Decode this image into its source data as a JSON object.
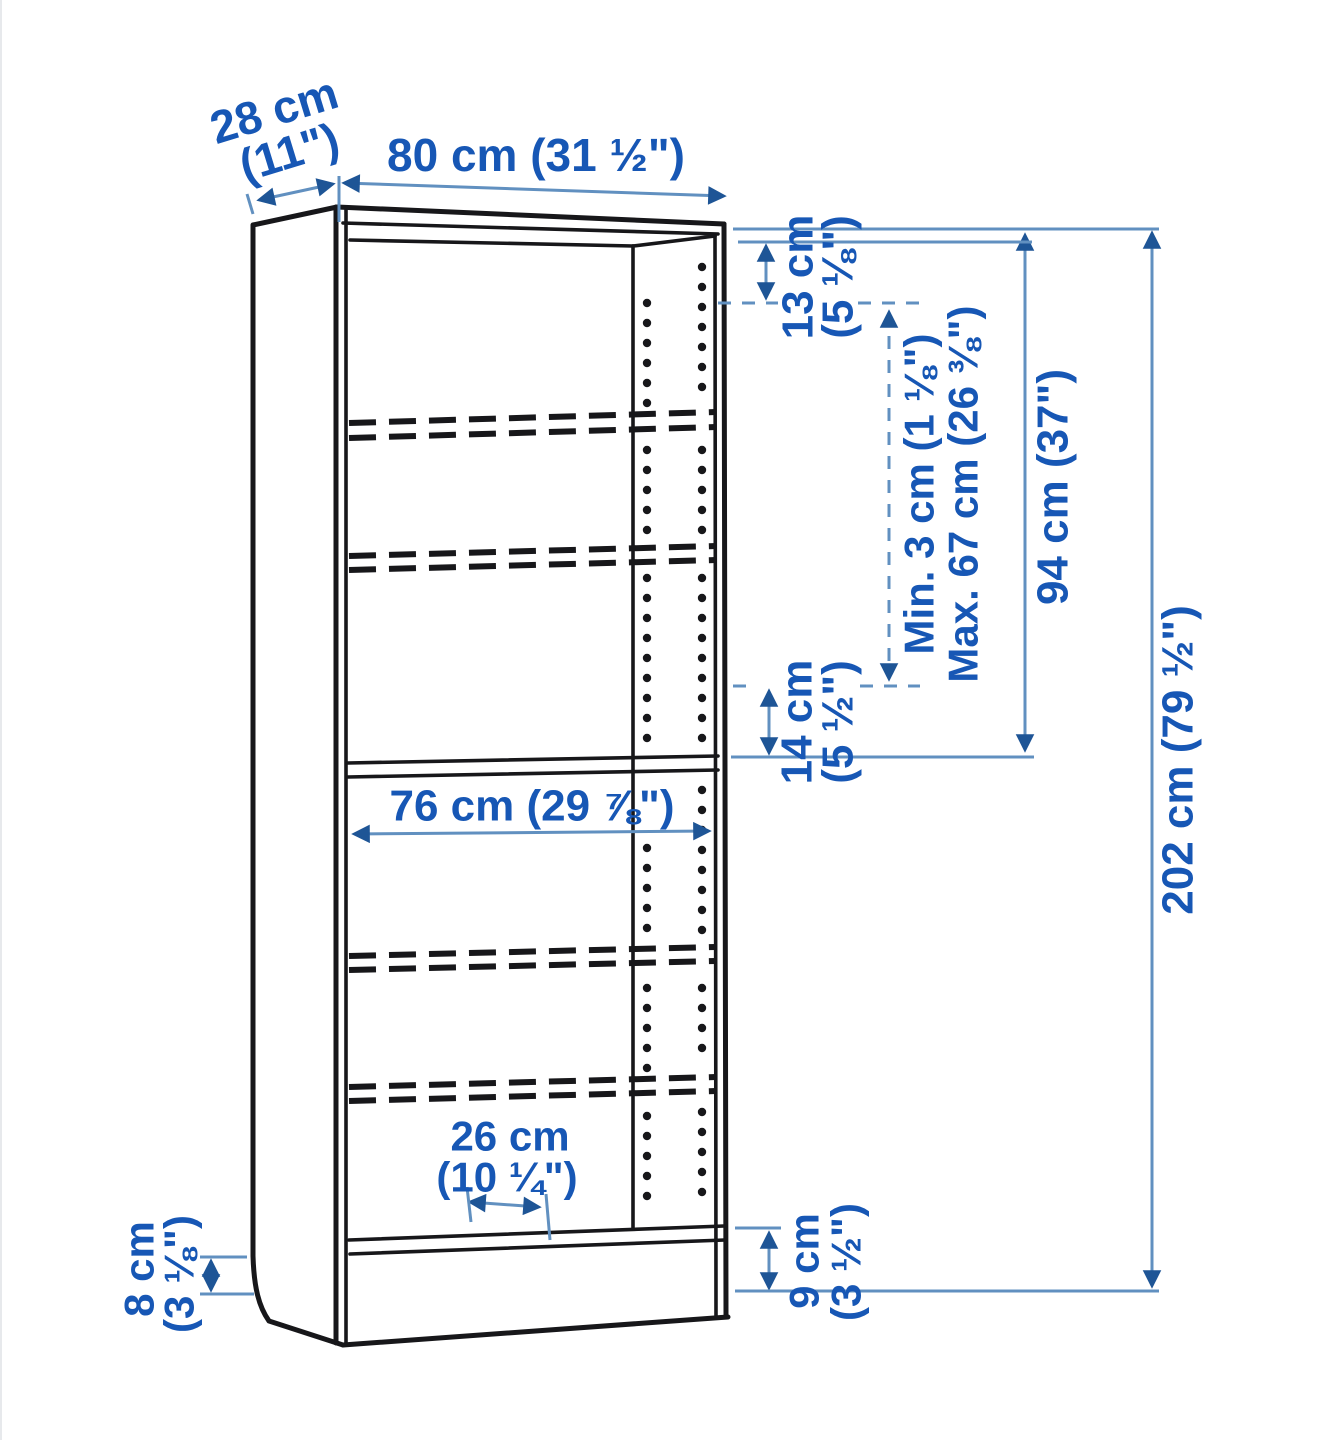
{
  "diagram": {
    "title": "bookcase dimension diagram",
    "colors": {
      "label_text": "#1757b5",
      "dimension_line": "#6190c0",
      "arrowhead": "#1e5596",
      "drawing_outline": "#17171a",
      "background": "#ffffff"
    },
    "dims": {
      "depth": {
        "line1": "28 cm",
        "line2": "(11\")"
      },
      "width": {
        "text": "80 cm (31 ½\")"
      },
      "top_gap": {
        "line1": "13 cm",
        "line2": "(5 ⅛\")"
      },
      "shelf_spacing": {
        "min": "Min. 3 cm (1 ⅛\")",
        "max": "Max. 67 cm (26 ⅜\")"
      },
      "upper_height": {
        "text": "94 cm (37\")"
      },
      "total_height": {
        "text": "202 cm (79 ½\")"
      },
      "middle_gap": {
        "line1": "14 cm",
        "line2": "(5 ½\")"
      },
      "inner_width": {
        "text": "76 cm (29 ⅞\")"
      },
      "shelf_depth": {
        "line1": "26 cm",
        "line2": "(10 ¼\")"
      },
      "base_height_back": {
        "line1": "8 cm",
        "line2": "(3 ⅛\")"
      },
      "base_height_front": {
        "line1": "9 cm",
        "line2": "(3 ½\")"
      }
    }
  }
}
